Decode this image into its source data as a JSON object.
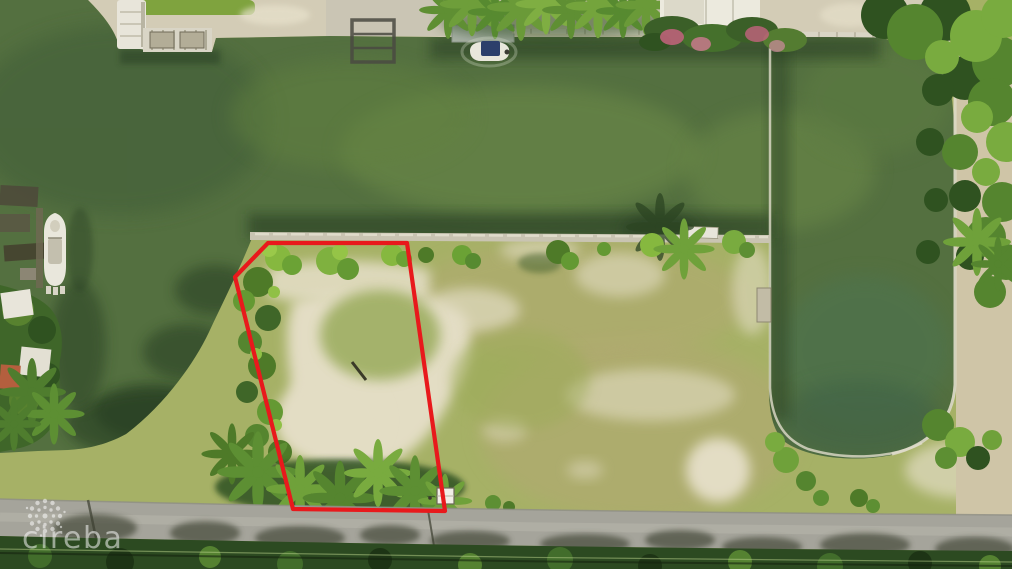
{
  "image": {
    "kind": "aerial-drone-photo",
    "subject": "vacant-waterfront-lot-outlined-in-red-between-canal-and-road"
  },
  "watermark": {
    "text": "cireba",
    "logo": "starburst-dots-icon"
  },
  "boundary": {
    "points": "268,243 407,243 445,511 293,509 235,277",
    "stroke_width": "4.2"
  },
  "palette": {
    "water": "#547040",
    "water_dark": "#47633b",
    "water_algae": "#6e8c4a",
    "water_shadow": "#263e22",
    "land_grass": "#a6b166",
    "land_tan": "#b3a873",
    "sand_patch": "#e3ddc4",
    "sand_shore": "#d3ccb6",
    "sand_dry": "#cfc5a7",
    "seawall": "#c9c4b2",
    "seawall_cap": "#e0dccb",
    "road": "#a5a49b",
    "road_shadow": "#4c503f",
    "veg_dark": "#2c4a21",
    "tree_dark": "#2f5220",
    "tree_mid": "#55852f",
    "tree_bright": "#79ab3f",
    "roof_white": "#e8e5da",
    "roof_terracotta": "#b45f3e",
    "boat_white": "#e9e7dc",
    "boat_canopy": "#2c3f6b",
    "hedge_pink": "#c4637e",
    "boundary_red": "#e8191c",
    "watermark_white": "#ffffff"
  }
}
